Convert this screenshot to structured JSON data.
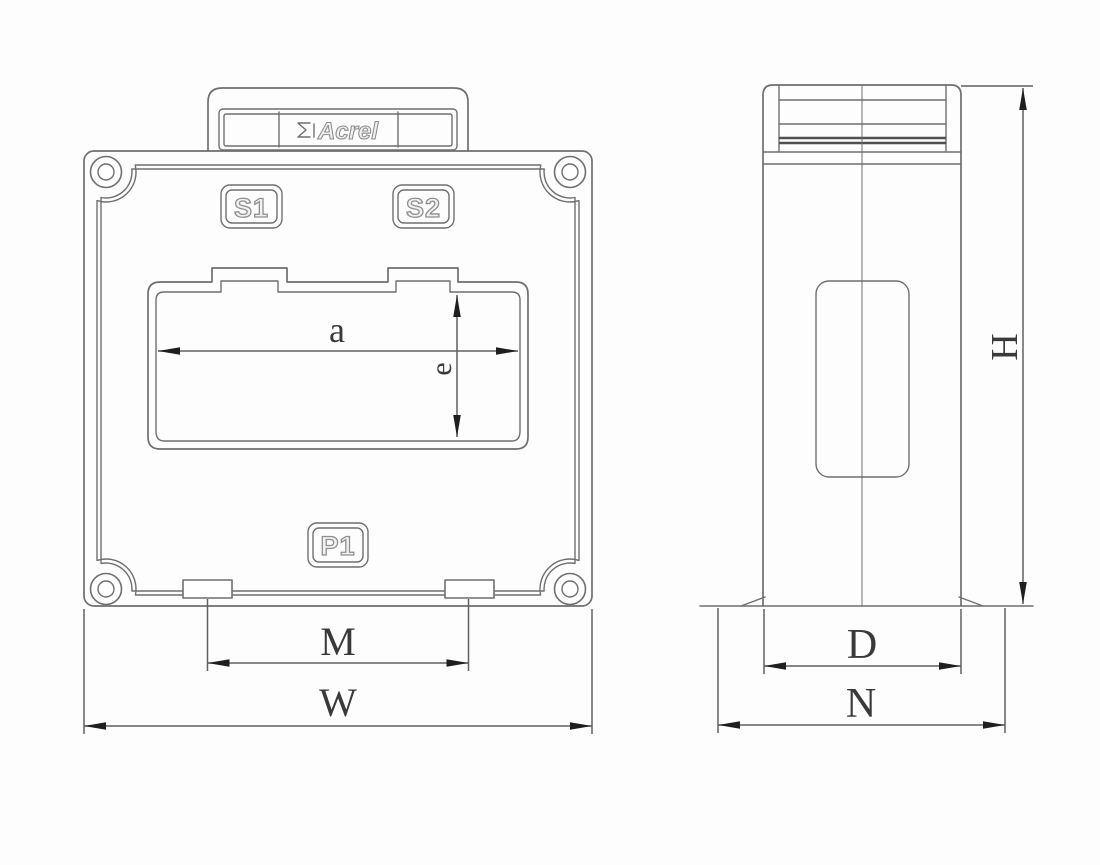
{
  "colors": {
    "line": "#6f6f6f",
    "line-dark": "#4f4f4f",
    "dim": "#606060",
    "arrow": "#1f1f1f",
    "text": "#3a3a3a",
    "engraved-stroke": "#8f8f8f",
    "engraved-fill": "#f1f1f1",
    "bg": "#fdfdfd"
  },
  "front_view": {
    "brand_label": "Acrel",
    "terminals": {
      "s1": "S1",
      "s2": "S2",
      "p1": "P1"
    },
    "dims": {
      "window_width": "a",
      "window_height": "e",
      "foot_spacing": "M",
      "overall_width": "W"
    }
  },
  "side_view": {
    "dims": {
      "height": "H",
      "depth": "D",
      "base_depth": "N"
    }
  }
}
